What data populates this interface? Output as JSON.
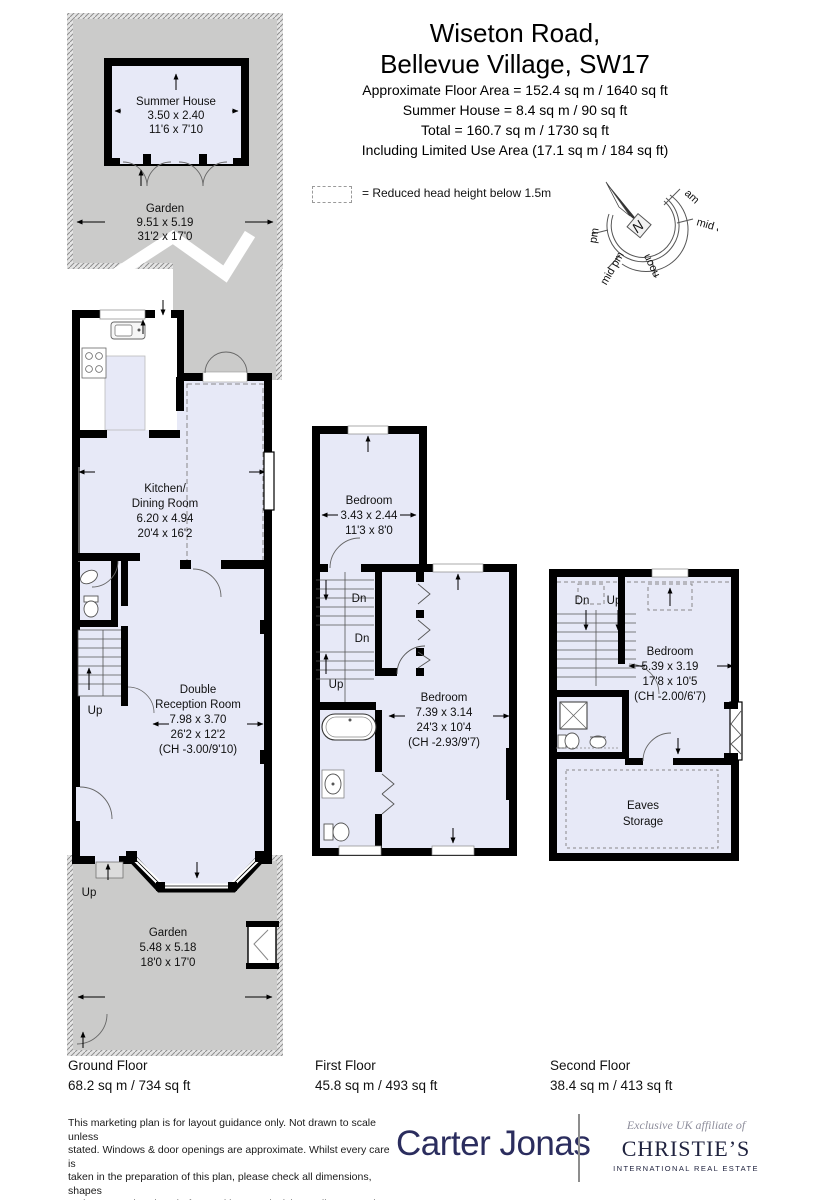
{
  "header": {
    "title_line1": "Wiseton Road,",
    "title_line2": "Bellevue Village, SW17",
    "area_lines": [
      "Approximate Floor Area = 152.4 sq m / 1640 sq ft",
      "Summer House = 8.4 sq m / 90 sq ft",
      "Total = 160.7 sq m / 1730 sq ft",
      "Including Limited Use Area (17.1 sq m / 184 sq ft)"
    ]
  },
  "legend": {
    "label": "= Reduced head height below 1.5m"
  },
  "compass": {
    "north": "N",
    "labels": [
      "am",
      "mid am",
      "noon",
      "mid pm",
      "pm"
    ]
  },
  "stairs": {
    "up": "Up",
    "dn": "Dn"
  },
  "ground": {
    "summer_house": {
      "name": "Summer House",
      "dim_m": "3.50 x 2.40",
      "dim_ft": "11'6 x 7'10"
    },
    "garden_top": {
      "name": "Garden",
      "dim_m": "9.51 x 5.19",
      "dim_ft": "31'2 x 17'0"
    },
    "kitchen": {
      "line1": "Kitchen/",
      "line2": "Dining Room",
      "dim_m": "6.20 x 4.94",
      "dim_ft": "20'4 x 16'2"
    },
    "reception": {
      "line1": "Double",
      "line2": "Reception Room",
      "dim_m": "7.98 x 3.70",
      "dim_ft": "26'2 x 12'2",
      "ch": "(CH -3.00/9'10)"
    },
    "garden_bottom": {
      "name": "Garden",
      "dim_m": "5.48 x 5.18",
      "dim_ft": "18'0 x 17'0"
    }
  },
  "first": {
    "bedroom_small": {
      "name": "Bedroom",
      "dim_m": "3.43 x 2.44",
      "dim_ft": "11'3 x 8'0"
    },
    "bedroom": {
      "name": "Bedroom",
      "dim_m": "7.39 x 3.14",
      "dim_ft": "24'3 x 10'4",
      "ch": "(CH -2.93/9'7)"
    }
  },
  "second": {
    "bedroom": {
      "name": "Bedroom",
      "dim_m": "5.39 x 3.19",
      "dim_ft": "17'8 x 10'5",
      "ch": "(CH -2.00/6'7)"
    },
    "eaves": {
      "line1": "Eaves",
      "line2": "Storage"
    }
  },
  "floors": [
    {
      "name": "Ground Floor",
      "area": "68.2 sq m / 734 sq ft"
    },
    {
      "name": "First Floor",
      "area": "45.8 sq m / 493 sq ft"
    },
    {
      "name": "Second Floor",
      "area": "38.4 sq m / 413 sq ft"
    }
  ],
  "footer": {
    "disclaimer_lines": [
      "This marketing plan is for layout guidance only. Not drawn to scale unless",
      "stated. Windows & door openings are approximate. Whilst every care is",
      "taken in the preparation of this plan, please check all dimensions, shapes",
      "and compass bearings before making any decisions reliant upon them."
    ],
    "carter_jonas": "Carter Jonas",
    "christies": {
      "affiliate": "Exclusive UK affiliate of",
      "name": "CHRISTIE’S",
      "subtitle": "INTERNATIONAL REAL ESTATE"
    }
  },
  "colors": {
    "room_fill": "#e7e9f7",
    "garden_fill": "#cbcbca",
    "wall": "#000000",
    "brand_navy": "#2b2d5e"
  }
}
